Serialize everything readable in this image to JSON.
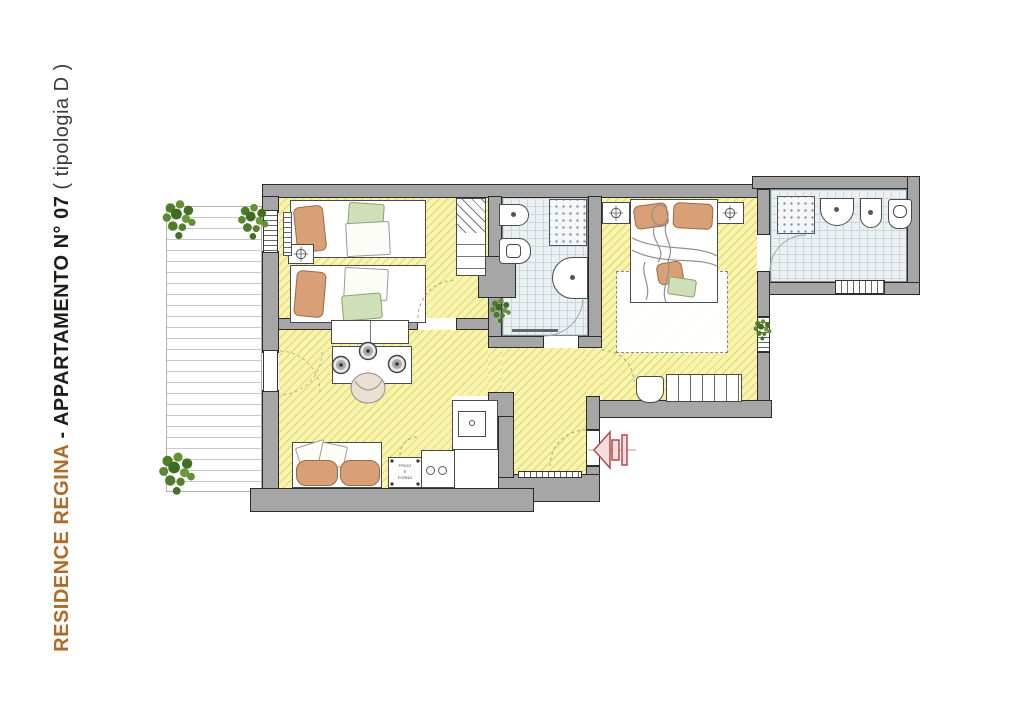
{
  "title": {
    "project": "RESIDENCE REGINA",
    "separator": " - ",
    "apartment": "APPARTAMENTO N° 07",
    "typology": " ( tipologia D )"
  },
  "labels": {
    "appliance_line1": "FRIGO",
    "appliance_line2": "E",
    "appliance_line3": "FORNO"
  },
  "colors": {
    "accent": "#b06a25",
    "text": "#1d1d1b",
    "wall": "#a6a6a6",
    "wall-outline": "#2a2a2a",
    "floor": "#f8f4ac",
    "tile": "#ebf0f2",
    "tile-line": "#ccd7dd",
    "arrow": "#b4494f",
    "plant": "#4e7d2a",
    "furniture-line": "#4a4a4a",
    "pillow": "#d9a077",
    "blanket": "#cfe0b8"
  },
  "icons": {
    "plant": "plant-icon",
    "lamp": "lamp-icon",
    "shower": "shower-tray-icon",
    "toilet": "toilet-icon",
    "bidet": "bidet-icon",
    "washbasin": "washbasin-icon",
    "entrance_arrow": "entrance-arrow-icon",
    "door_swing": "door-swing-arc"
  }
}
